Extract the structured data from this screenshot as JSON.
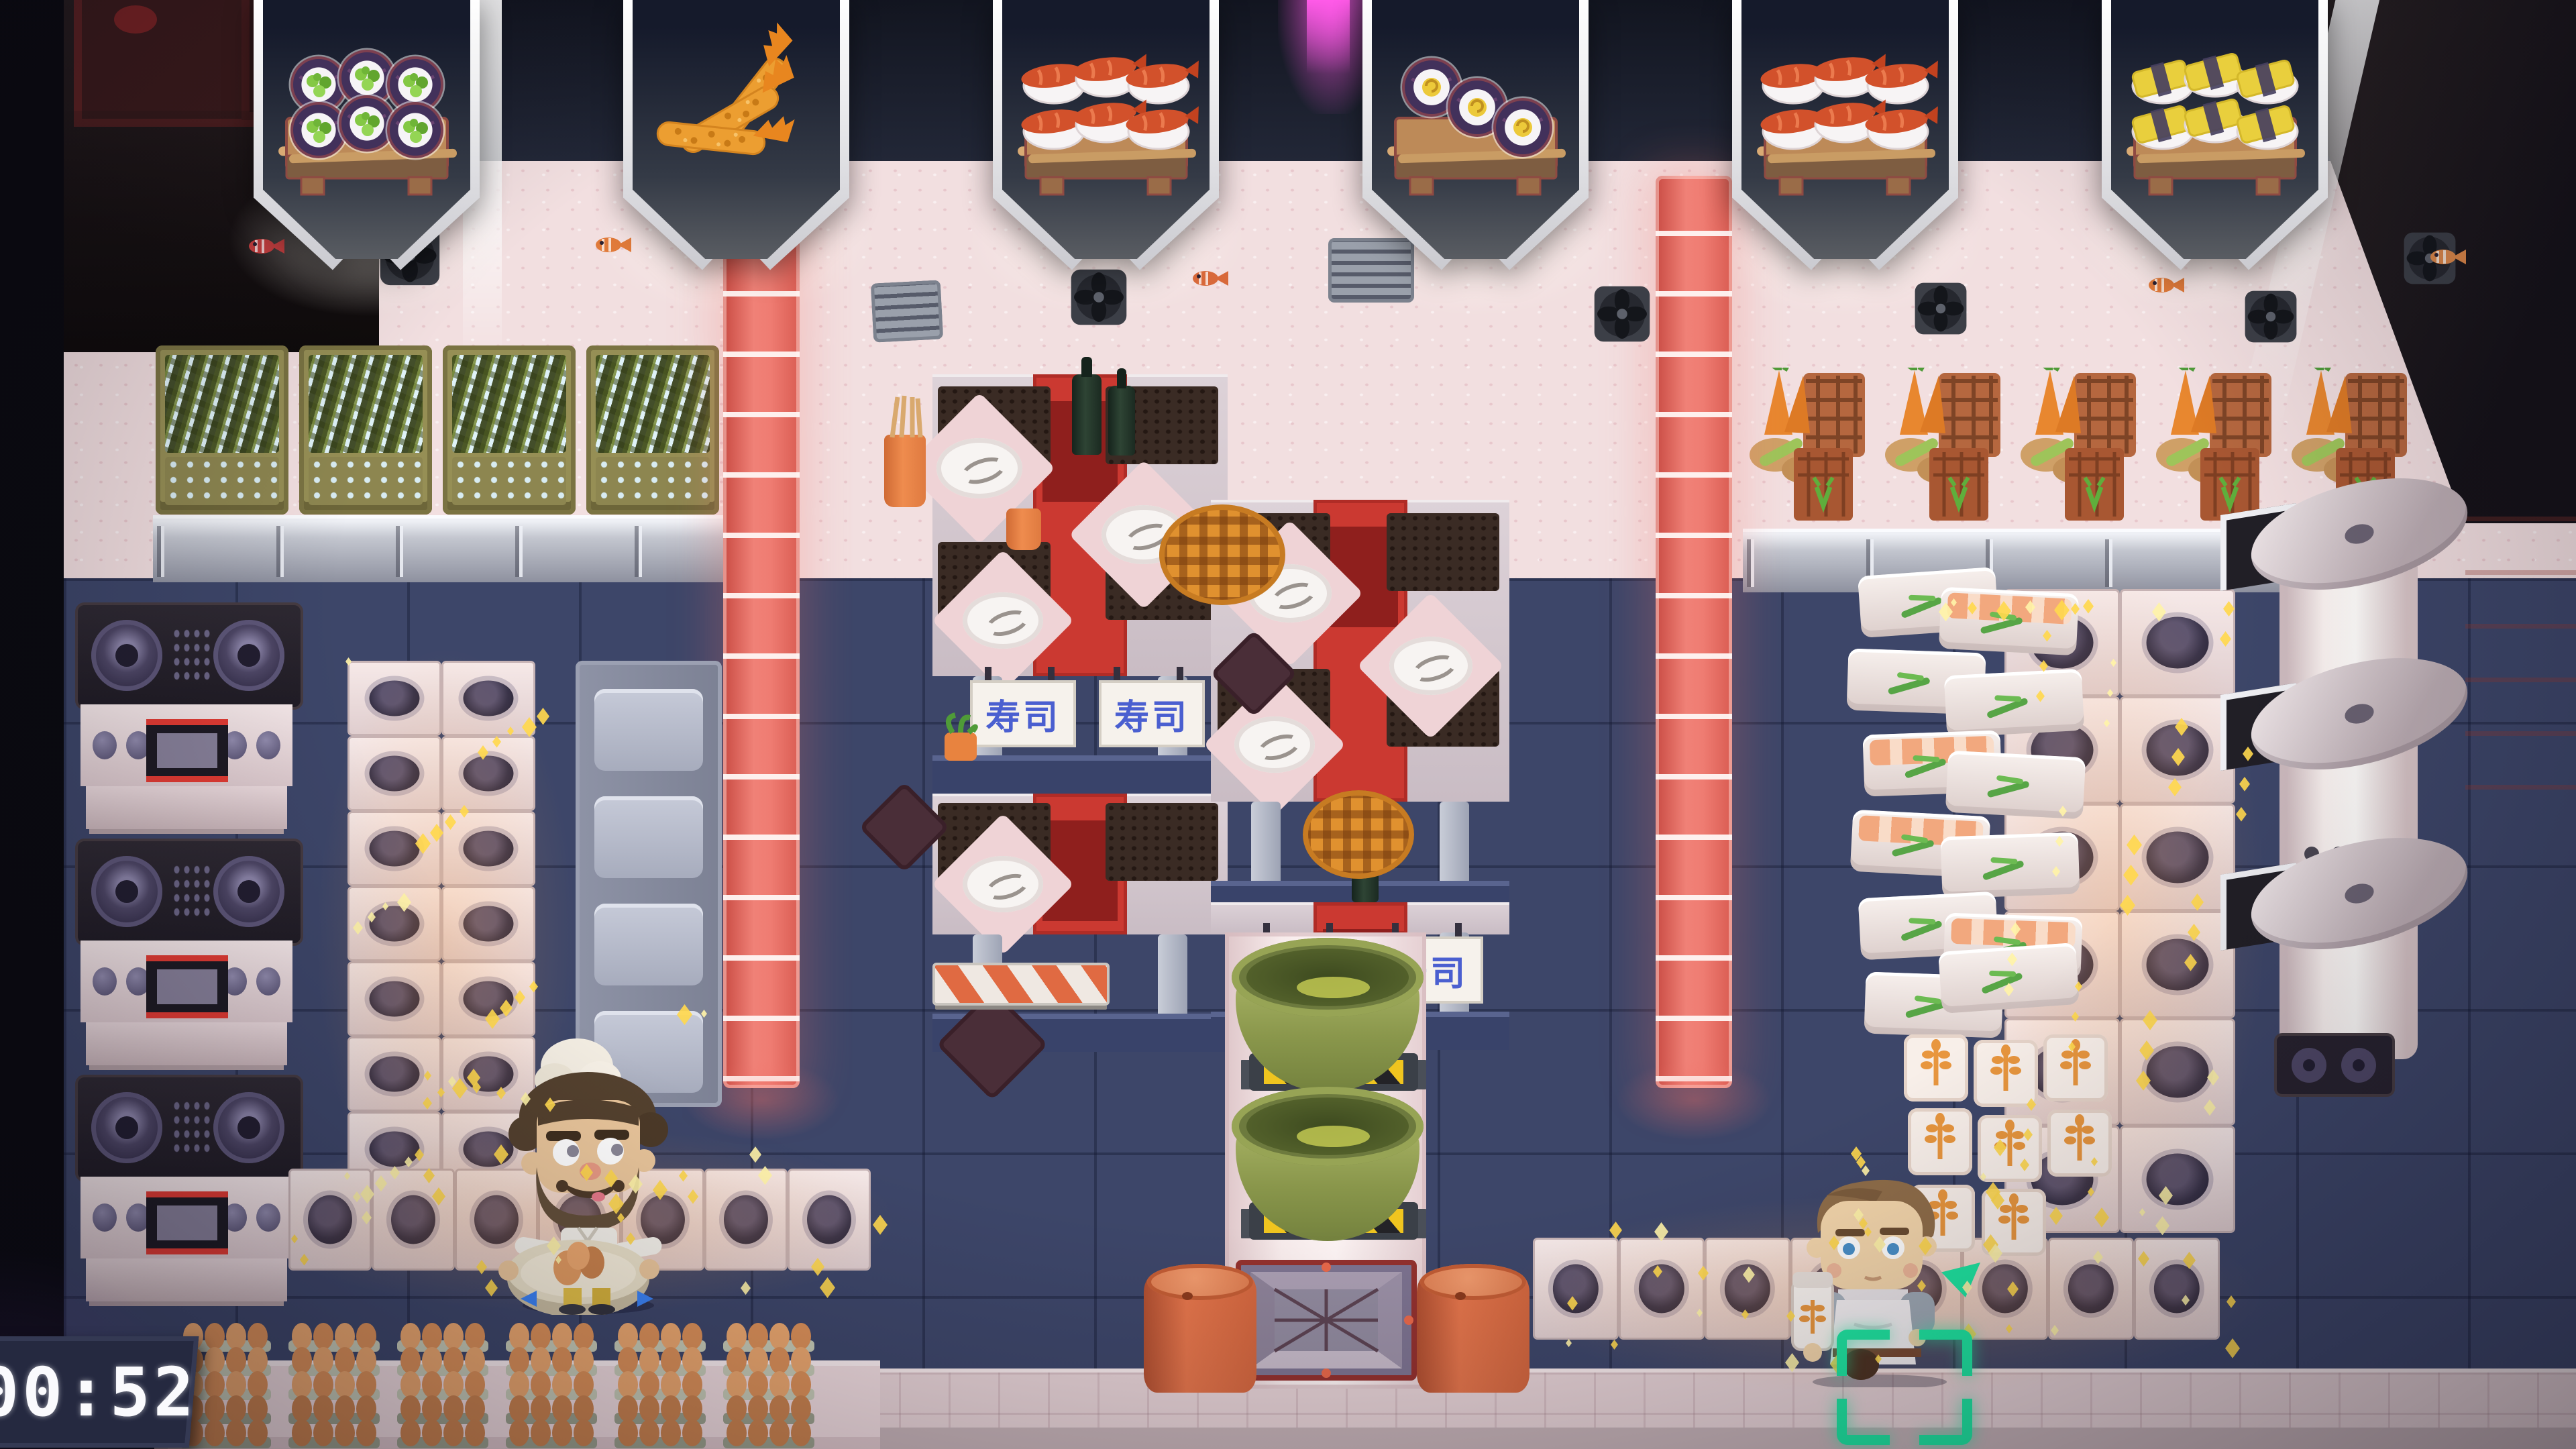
{
  "hud": {
    "timer_label": "00:52",
    "orders": [
      {
        "dish": "cucumber-maki-roll",
        "count": 6
      },
      {
        "dish": "shrimp-tempura",
        "count": 3
      },
      {
        "dish": "shrimp-nigiri",
        "count": 6
      },
      {
        "dish": "tamago-maki-roll",
        "count": 3
      },
      {
        "dish": "shrimp-nigiri",
        "count": 6
      },
      {
        "dish": "tamago-nigiri",
        "count": 6
      }
    ]
  },
  "scene": {
    "sushi_sign_text": "寿司",
    "stations": {
      "stove_count": 3,
      "seaweed_crate_count": 4,
      "vegetable_crate_count": 5,
      "egg_carton_stacks": 6,
      "matcha_bowl_count": 2,
      "barrel_count": 2,
      "rice_cooker_count": 3,
      "table_cluster_count": 2
    },
    "characters": [
      {
        "id": "bearded-chef",
        "carrying": "bowl-of-eggs"
      },
      {
        "id": "young-chef",
        "carrying": "rice-shaker"
      }
    ]
  },
  "colors": {
    "selection_green": "#1fe6a1",
    "conveyor_red": "#ef7c72",
    "spark_yellow": "#ffd84e",
    "banner_navy": "#151a2b",
    "table_runner_red": "#cb3931",
    "magenta_glow": "#ff5ae8"
  }
}
